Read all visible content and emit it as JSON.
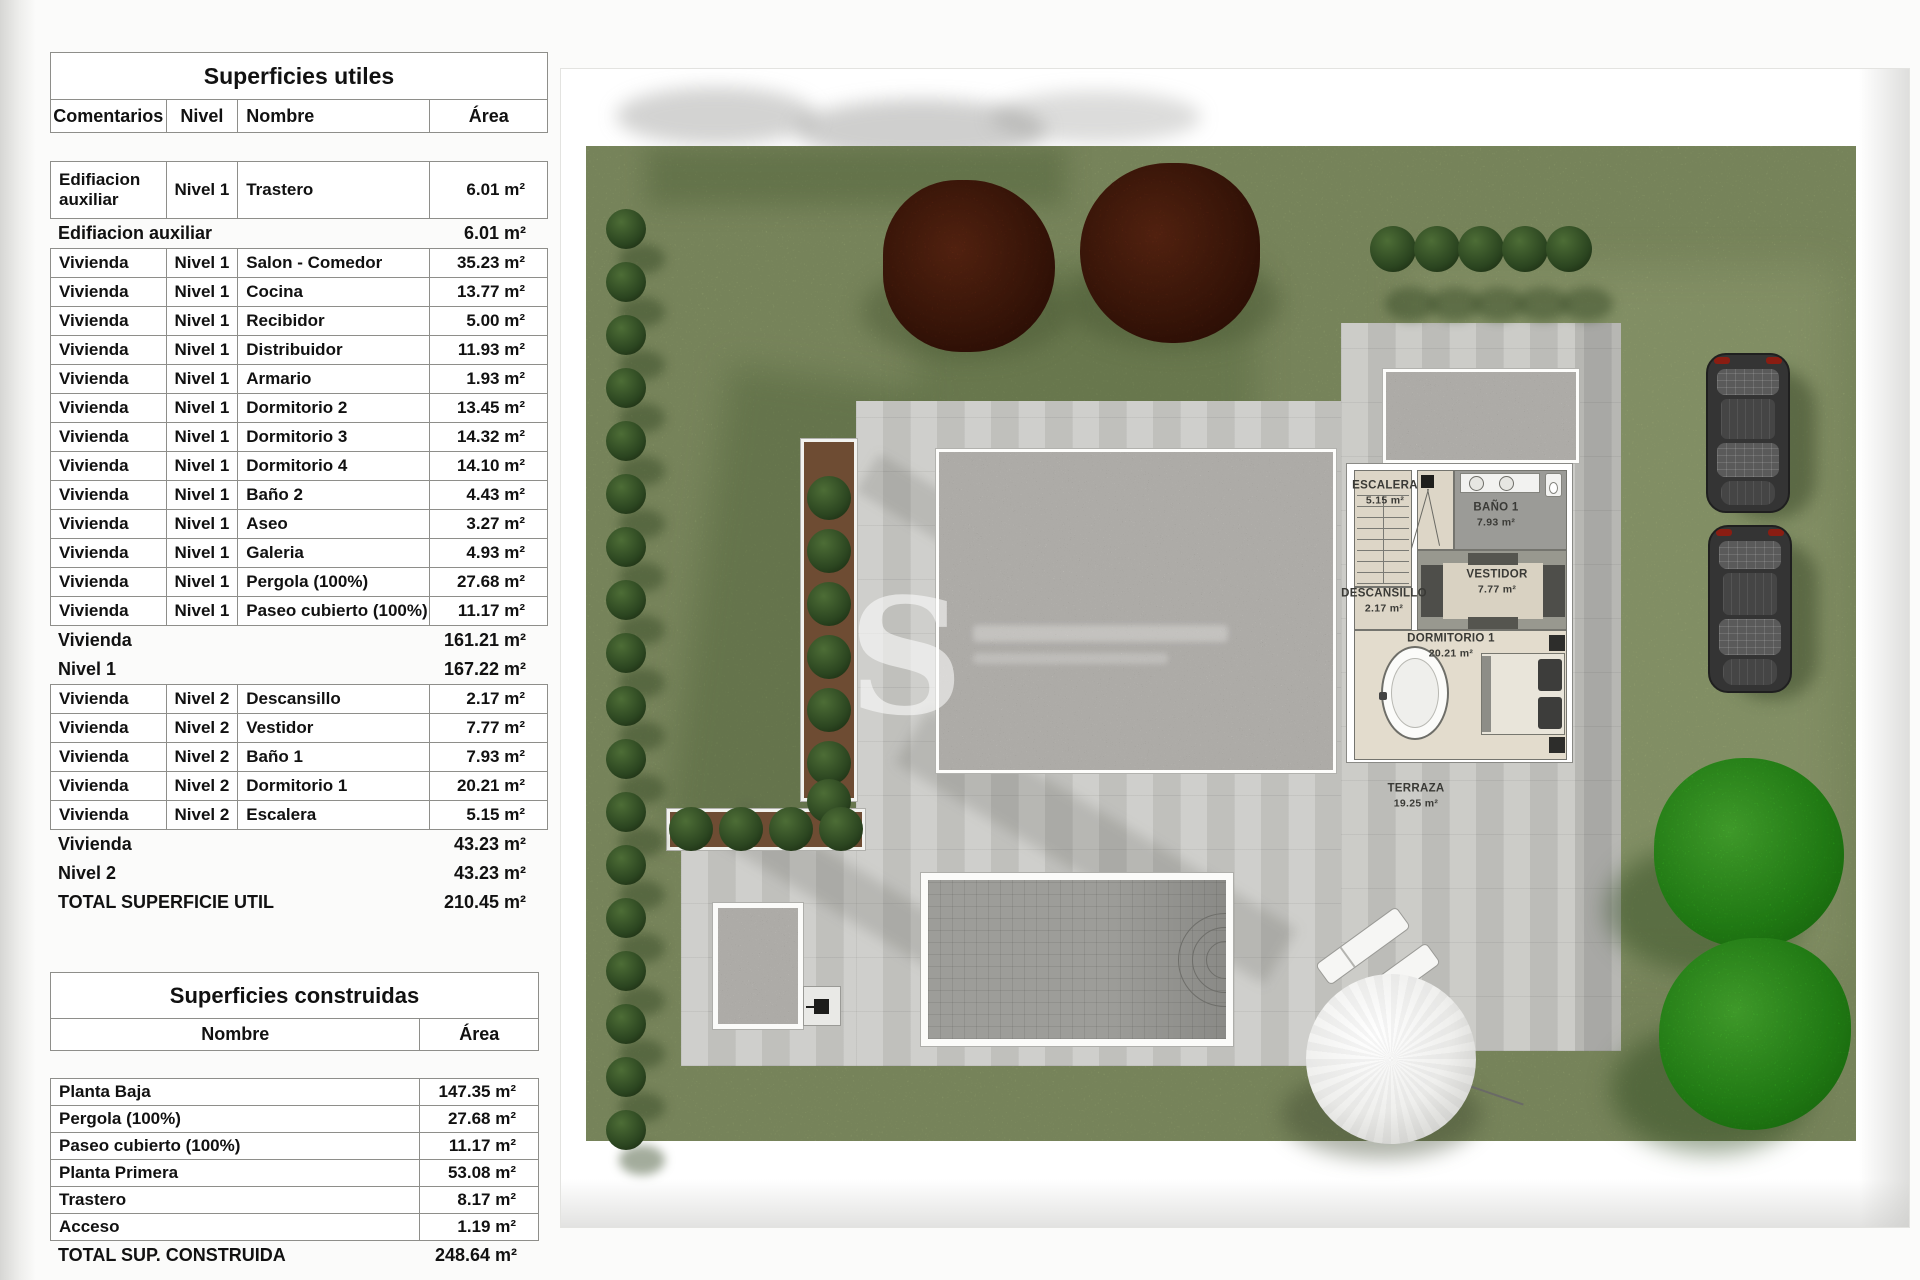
{
  "superficies_utiles": {
    "title": "Superficies utiles",
    "headers": {
      "comentarios": "Comentarios",
      "nivel": "Nivel",
      "nombre": "Nombre",
      "area": "Área"
    },
    "rows": [
      {
        "type": "data2",
        "comentarios": "Edifiacion auxiliar",
        "nivel": "Nivel 1",
        "nombre": "Trastero",
        "area": "6.01 m²"
      },
      {
        "type": "summary",
        "label": "Edifiacion auxiliar",
        "area": "6.01 m²"
      },
      {
        "type": "data",
        "comentarios": "Vivienda",
        "nivel": "Nivel 1",
        "nombre": "Salon - Comedor",
        "area": "35.23 m²"
      },
      {
        "type": "data",
        "comentarios": "Vivienda",
        "nivel": "Nivel 1",
        "nombre": "Cocina",
        "area": "13.77 m²"
      },
      {
        "type": "data",
        "comentarios": "Vivienda",
        "nivel": "Nivel 1",
        "nombre": "Recibidor",
        "area": "5.00 m²"
      },
      {
        "type": "data",
        "comentarios": "Vivienda",
        "nivel": "Nivel 1",
        "nombre": "Distribuidor",
        "area": "11.93 m²"
      },
      {
        "type": "data",
        "comentarios": "Vivienda",
        "nivel": "Nivel 1",
        "nombre": "Armario",
        "area": "1.93 m²"
      },
      {
        "type": "data",
        "comentarios": "Vivienda",
        "nivel": "Nivel 1",
        "nombre": "Dormitorio 2",
        "area": "13.45 m²"
      },
      {
        "type": "data",
        "comentarios": "Vivienda",
        "nivel": "Nivel 1",
        "nombre": "Dormitorio 3",
        "area": "14.32 m²"
      },
      {
        "type": "data",
        "comentarios": "Vivienda",
        "nivel": "Nivel 1",
        "nombre": "Dormitorio 4",
        "area": "14.10 m²"
      },
      {
        "type": "data",
        "comentarios": "Vivienda",
        "nivel": "Nivel 1",
        "nombre": "Baño 2",
        "area": "4.43 m²"
      },
      {
        "type": "data",
        "comentarios": "Vivienda",
        "nivel": "Nivel 1",
        "nombre": "Aseo",
        "area": "3.27 m²"
      },
      {
        "type": "data",
        "comentarios": "Vivienda",
        "nivel": "Nivel 1",
        "nombre": "Galeria",
        "area": "4.93 m²"
      },
      {
        "type": "data",
        "comentarios": "Vivienda",
        "nivel": "Nivel 1",
        "nombre": "Pergola (100%)",
        "area": "27.68 m²"
      },
      {
        "type": "data",
        "comentarios": "Vivienda",
        "nivel": "Nivel 1",
        "nombre": "Paseo cubierto (100%)",
        "area": "11.17 m²"
      },
      {
        "type": "summary",
        "label": "Vivienda",
        "area": "161.21 m²"
      },
      {
        "type": "summary",
        "label": "Nivel 1",
        "area": "167.22 m²"
      },
      {
        "type": "data",
        "comentarios": "Vivienda",
        "nivel": "Nivel 2",
        "nombre": "Descansillo",
        "area": "2.17 m²"
      },
      {
        "type": "data",
        "comentarios": "Vivienda",
        "nivel": "Nivel 2",
        "nombre": "Vestidor",
        "area": "7.77 m²"
      },
      {
        "type": "data",
        "comentarios": "Vivienda",
        "nivel": "Nivel 2",
        "nombre": "Baño 1",
        "area": "7.93 m²"
      },
      {
        "type": "data",
        "comentarios": "Vivienda",
        "nivel": "Nivel 2",
        "nombre": "Dormitorio 1",
        "area": "20.21 m²"
      },
      {
        "type": "data",
        "comentarios": "Vivienda",
        "nivel": "Nivel 2",
        "nombre": "Escalera",
        "area": "5.15 m²"
      },
      {
        "type": "summary",
        "label": "Vivienda",
        "area": "43.23 m²"
      },
      {
        "type": "summary",
        "label": "Nivel 2",
        "area": "43.23 m²"
      },
      {
        "type": "total",
        "label": "TOTAL SUPERFICIE UTIL",
        "area": "210.45 m²"
      }
    ]
  },
  "superficies_construidas": {
    "title": "Superficies construidas",
    "headers": {
      "nombre": "Nombre",
      "area": "Área"
    },
    "rows": [
      {
        "type": "data",
        "nombre": "Planta Baja",
        "area": "147.35 m²"
      },
      {
        "type": "data",
        "nombre": "Pergola (100%)",
        "area": "27.68 m²"
      },
      {
        "type": "data",
        "nombre": "Paseo cubierto (100%)",
        "area": "11.17 m²"
      },
      {
        "type": "data",
        "nombre": "Planta Primera",
        "area": "53.08 m²"
      },
      {
        "type": "data",
        "nombre": "Trastero",
        "area": "8.17 m²"
      },
      {
        "type": "data",
        "nombre": "Acceso",
        "area": "1.19 m²"
      },
      {
        "type": "total",
        "label": "TOTAL SUP. CONSTRUIDA",
        "area": "248.64 m²"
      }
    ]
  },
  "plan": {
    "watermark_letter": "S",
    "room_labels": [
      {
        "name": "ESCALERA",
        "area": "5.15 m²"
      },
      {
        "name": "BAÑO 1",
        "area": "7.93 m²"
      },
      {
        "name": "DESCANSILLO",
        "area": "2.17 m²"
      },
      {
        "name": "VESTIDOR",
        "area": "7.77 m²"
      },
      {
        "name": "DORMITORIO 1",
        "area": "20.21 m²"
      },
      {
        "name": "TERRAZA",
        "area": "19.25 m²"
      }
    ],
    "colors": {
      "grass": "#95a571",
      "paving": "#cacac6",
      "gravel": "#d8d4c7",
      "pool": "#9d9d99",
      "bush_dark": "#2b4520",
      "tree_bright": "#2fae1d",
      "tree_red": "#55200d",
      "floor_beige": "#ddd6c7"
    }
  }
}
